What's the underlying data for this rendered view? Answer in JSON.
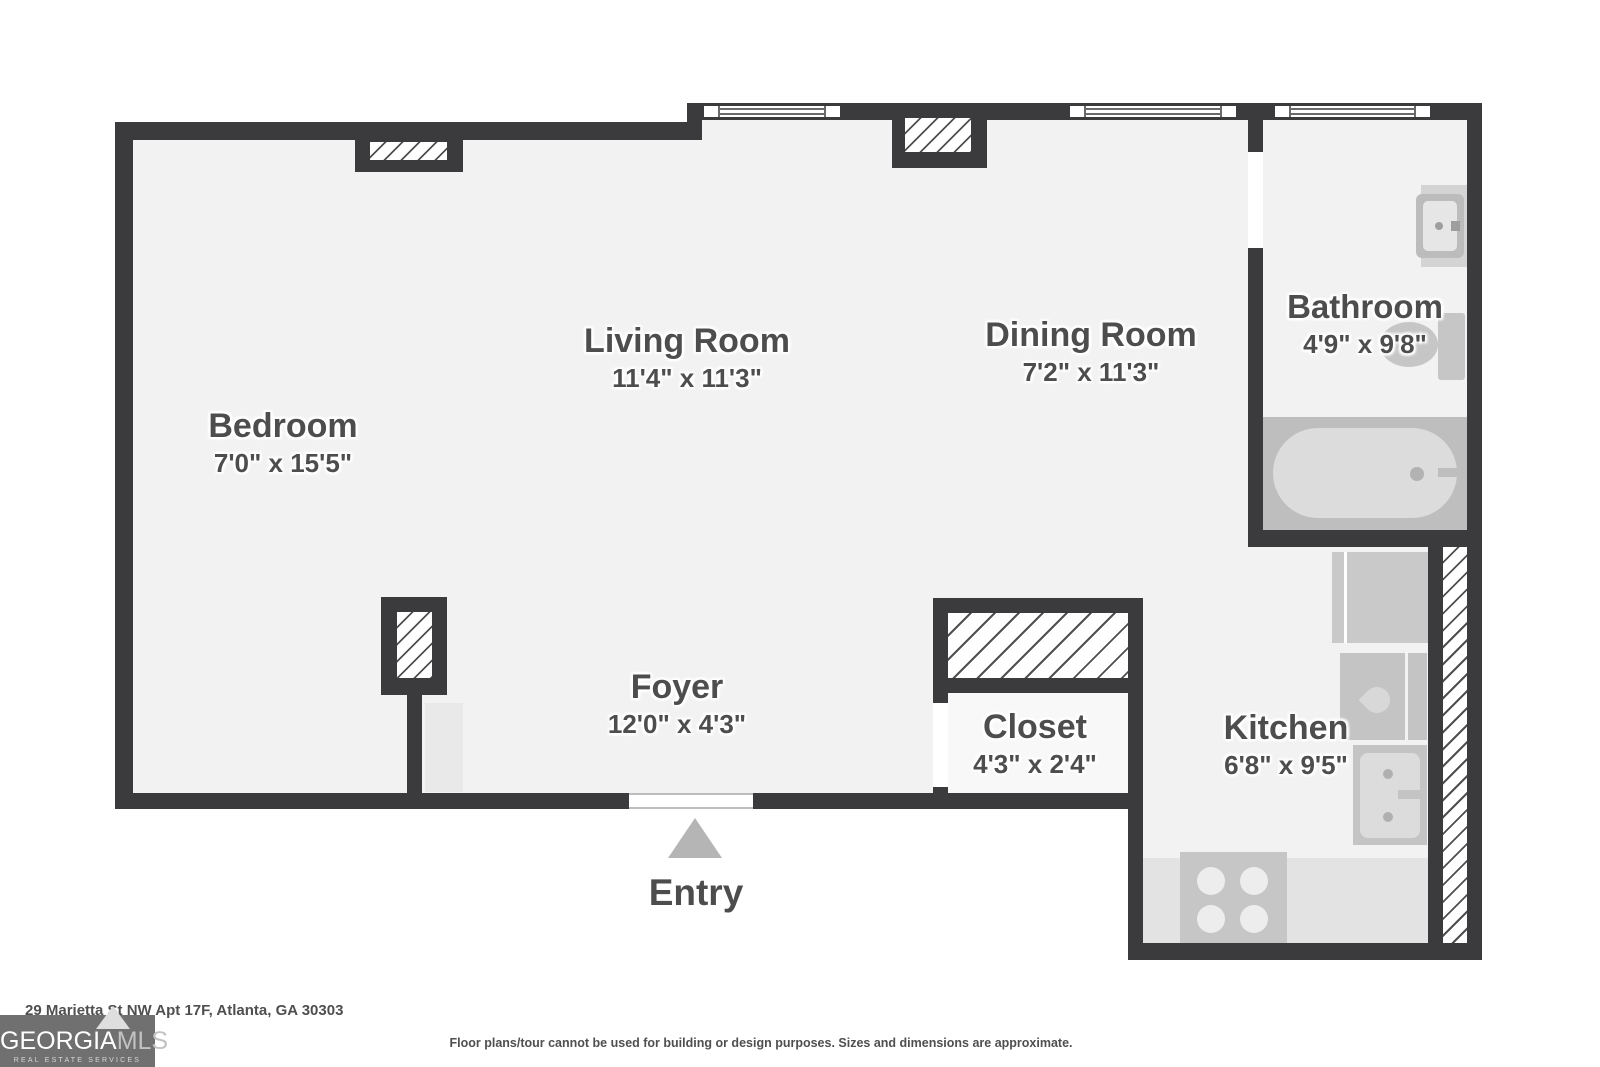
{
  "floorplan": {
    "rooms": [
      {
        "name": "Bedroom",
        "dims": "7'0\" x 15'5\""
      },
      {
        "name": "Living Room",
        "dims": "11'4\" x 11'3\""
      },
      {
        "name": "Dining Room",
        "dims": "7'2\" x 11'3\""
      },
      {
        "name": "Bathroom",
        "dims": "4'9\" x 9'8\""
      },
      {
        "name": "Foyer",
        "dims": "12'0\" x 4'3\""
      },
      {
        "name": "Closet",
        "dims": "4'3\" x 2'4\""
      },
      {
        "name": "Kitchen",
        "dims": "6'8\" x 9'5\""
      }
    ],
    "entry_label": "Entry",
    "fixtures": [
      "bathtub",
      "toilet",
      "bathroom-sink",
      "refrigerator",
      "kitchen-sink",
      "dishwasher",
      "stove-cooktop"
    ],
    "colors": {
      "wall": "#3b3b3d",
      "floor": "#f2f2f2",
      "fixture": "#c6c6c6",
      "label_text": "#4d4d4d",
      "entry_arrow": "#b5b5b5"
    }
  },
  "footer": {
    "address": "29 Marietta St NW Apt 17F, Atlanta, GA 30303",
    "disclaimer": "Floor plans/tour cannot be used for building or design purposes. Sizes and dimensions are approximate."
  },
  "logo": {
    "name_part1": "GEORGIA",
    "name_part2": "MLS",
    "tagline": "REAL ESTATE SERVICES"
  }
}
